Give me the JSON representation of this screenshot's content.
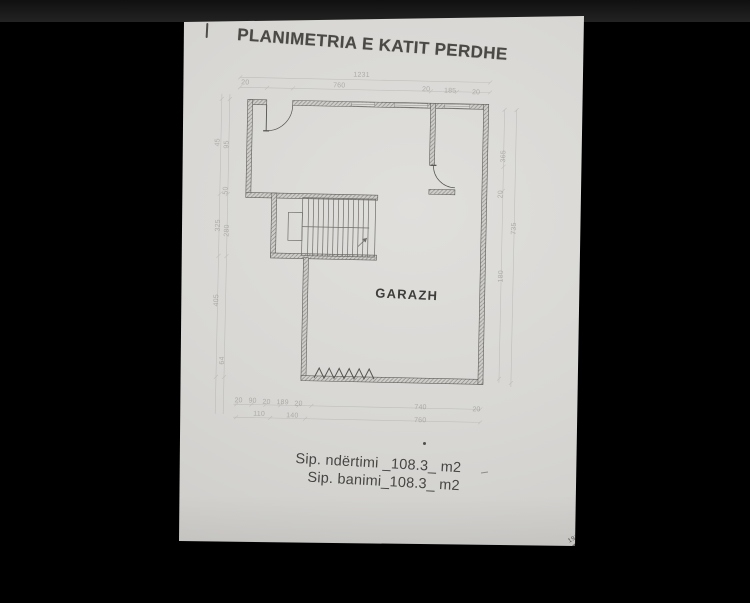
{
  "page": {
    "title": "PLANIMETRIA E KATIT PERDHE"
  },
  "plan": {
    "room_label": "GARAZH"
  },
  "summary": {
    "line1": "Sip. ndërtimi  _108.3_ m2",
    "line2": "Sip. banimi_108.3_ m2"
  },
  "dimensions": {
    "top_total": "1231",
    "top_row": [
      "20",
      "760",
      "20",
      "185",
      "20"
    ],
    "bottom_row1": [
      "20",
      "90",
      "20",
      "189",
      "20",
      "740",
      "20"
    ],
    "bottom_row2": [
      "110",
      "140",
      "760"
    ],
    "left_col": [
      "45",
      "95",
      "50",
      "325",
      "280",
      "405",
      "64"
    ],
    "right_col": [
      "365",
      "20",
      "735",
      "180"
    ],
    "stamp_text": "191"
  }
}
